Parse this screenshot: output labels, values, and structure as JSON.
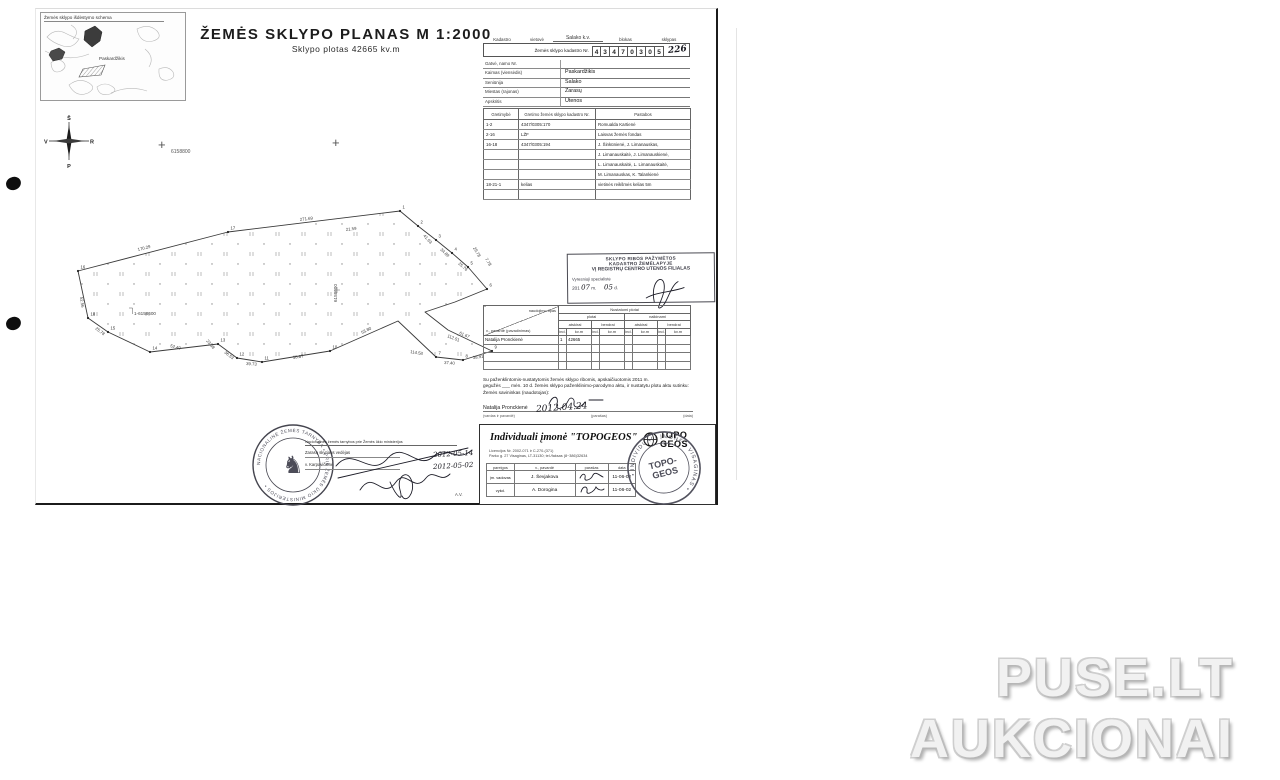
{
  "titles": {
    "main": "ŽEMĖS  SKLYPO  PLANAS  M 1:2000",
    "subtitle": "Sklypo  plotas 42665 kv.m"
  },
  "inset_map": {
    "title": "Žemės sklypo išdėstymo schema",
    "label1": "Paskardžikis"
  },
  "compass": {
    "north": "Š",
    "south": "P",
    "west": "V",
    "east": "R"
  },
  "grid": {
    "cross1_label": "6158800",
    "vertical_label": "6158600",
    "bracket_label": "1-6158600"
  },
  "cadastre_header": {
    "col_kadastro": "Kadastro",
    "col_vietove": "vietovė",
    "vietove_value": "Salako k.v.",
    "col_blokas": "blokas",
    "col_sklypas": "sklypas",
    "kadastro_nr_label": "Žemės sklypo kadastro Nr.",
    "digits": [
      "4",
      "3",
      "4",
      "7",
      "0",
      "3",
      "0",
      "5"
    ],
    "sklypas_handwritten": "226"
  },
  "location": {
    "rows": [
      {
        "label": "Gatvė, namo Nr.",
        "value": ""
      },
      {
        "label": "Kaimas (viensėdis)",
        "value": "Paskardžikis"
      },
      {
        "label": "Seniūnija",
        "value": "Salako"
      },
      {
        "label": "Miestas (rajonas)",
        "value": "Zarasų"
      },
      {
        "label": "Apskritis",
        "value": "Utenos"
      }
    ]
  },
  "adjacency": {
    "headers": [
      "Gretimybė",
      "Gretimo  žemės sklypo kadastro Nr.",
      "Pastabos"
    ],
    "rows": [
      [
        "1-2",
        "4347/0305:170",
        "Romualda Kartienė"
      ],
      [
        "2-16",
        "LŽF",
        "Laisvas žemės fondas"
      ],
      [
        "16-18",
        "4347/0305:194",
        "J. Šinkūnienė, J. Limanauskas,"
      ],
      [
        "",
        "",
        "J. Limanauskaitė, J. Limanauskienė,"
      ],
      [
        "",
        "",
        "L. Limanauskaitė, L. Limanauskaitė,"
      ],
      [
        "",
        "",
        "M. Limanauskas, K. Talankienė"
      ],
      [
        "18-21-1",
        "kelias",
        "vietinės reikšmės kelias 5m"
      ],
      [
        "",
        "",
        ""
      ]
    ]
  },
  "registry_stamp": {
    "line1": "SKLYPO RIBOS PAŽYMĖTOS",
    "line2": "KADASTRO ŽEMĖLAPYJE",
    "line3": "VĮ REGISTRŲ CENTRO UTENOS FILIALAS",
    "line4": "Vyresnioji specialistė",
    "date_prefix": "201",
    "m_label": "m.",
    "d_label": "d.",
    "hw_month": "07",
    "hw_day": "05"
  },
  "areas_table": {
    "diag_top": "naudojimo tipas",
    "diag_bottom": "v., pavardė (pavadinimas)",
    "group_title": "Nustatomi plotai",
    "group_left": "plotai",
    "group_right": "naikinami",
    "sub_left1": "atskirai",
    "sub_left2": "bendrai",
    "sub_right1": "atskirai",
    "sub_right2": "bendrai",
    "unit_ind": "ind.",
    "unit_kvm": "kv.m",
    "rows": [
      [
        "Natalija Pronckienė",
        "1",
        "42665",
        "",
        "",
        "",
        "",
        "",
        ""
      ],
      [
        "",
        "",
        "",
        "",
        "",
        "",
        "",
        "",
        ""
      ],
      [
        "",
        "",
        "",
        "",
        "",
        "",
        "",
        "",
        ""
      ],
      [
        "",
        "",
        "",
        "",
        "",
        "",
        "",
        "",
        ""
      ]
    ]
  },
  "agreement": {
    "line1": "Su paženklintomis-nustatytomis žemės sklypo ribomis, apskaičiuotomis 2011 m.",
    "line2": "gegužės ___ mėn. 10 d. žemės sklypo paženklinimo-parodymo aktu, ir nustatytu plotu aktu sutinku:",
    "line3": "Žemės savininkas (naudotojas):",
    "owner_name": "Natalija Pronckienė",
    "owner_date": "2012.04.24",
    "cap_name": "(vardas ir pavardė)",
    "cap_sig": "(parašas)",
    "cap_date": "(data)"
  },
  "surveyor": {
    "title": "Individuali įmonė \"TOPOGEOS\"",
    "logo_top": "TOPO",
    "logo_bottom": "GEOS",
    "license_line": "Licencijos Nr. 2002-071 ir C-270-(371)",
    "address_line": "Parko g. 27 Visaginas, LT-31130; tel./faksas (8~386)32634",
    "table_headers": [
      "pareigos",
      "v., pavardė",
      "parašas",
      "data"
    ],
    "rows": [
      {
        "role": "įm. vadovas",
        "name": "J. Ševjakova",
        "date": "11-06-02"
      },
      {
        "role": "vykd.",
        "name": "A. Dorogina",
        "date": "11-06-02"
      }
    ],
    "stamp_ring": "• INDIVIDUALI ĮMONĖ • VISAGINAS •",
    "stamp_center1": "TOPO-",
    "stamp_center2": "GEOS"
  },
  "approval": {
    "line1": "Nacionalinės žemės tarnybos prie Žemės ūkio ministerijos",
    "line2": "Zarasų skyriaus vedėjas",
    "line3": "v. Karpavičienė",
    "date1": "2012-05-14",
    "date2": "2012-05-02",
    "av": "A.V.",
    "seal_ring": "NACIONALINĖ ŽEMĖS TARNYBA • PRIE ŽEMĖS ŪKIO MINISTERIJOS •"
  },
  "watermark": {
    "line1": "PUSE.LT",
    "line2": "AUKCIONAI",
    "color": "#d9d9d9"
  },
  "drawing": {
    "polygon_points": "78,271 228,232 400,211 418,226 436,240 452,253 468,267 487,289 455,302 425,312 448,330 492,351 463,360 436,357 398,321 330,351 262,362 237,358 218,344 150,352 108,332 88,318",
    "edge_labels": [
      {
        "t": "170.29",
        "x": 138,
        "y": 251,
        "r": -14
      },
      {
        "t": "271.69",
        "x": 300,
        "y": 221,
        "r": -7
      },
      {
        "t": "21.59",
        "x": 346,
        "y": 231,
        "r": -7
      },
      {
        "t": "41.63",
        "x": 423,
        "y": 236,
        "r": 48
      },
      {
        "t": "34.89",
        "x": 440,
        "y": 250,
        "r": 44
      },
      {
        "t": "25.76",
        "x": 458,
        "y": 264,
        "r": 42
      },
      {
        "t": "29.78",
        "x": 473,
        "y": 248,
        "r": 60
      },
      {
        "t": "7.78",
        "x": 485,
        "y": 259,
        "r": 60
      },
      {
        "t": "112.51",
        "x": 447,
        "y": 337,
        "r": 22
      },
      {
        "t": "114.58",
        "x": 410,
        "y": 353,
        "r": 9
      },
      {
        "t": "61.67",
        "x": 459,
        "y": 334,
        "r": 24
      },
      {
        "t": "37.40",
        "x": 444,
        "y": 364,
        "r": 3
      },
      {
        "t": "38.91",
        "x": 473,
        "y": 359,
        "r": -7
      },
      {
        "t": "53.80",
        "x": 362,
        "y": 334,
        "r": -26
      },
      {
        "t": "58.67",
        "x": 293,
        "y": 359,
        "r": -9
      },
      {
        "t": "39.73",
        "x": 246,
        "y": 365,
        "r": 3
      },
      {
        "t": "36.53",
        "x": 224,
        "y": 353,
        "r": 38
      },
      {
        "t": "23.68",
        "x": 206,
        "y": 341,
        "r": 50
      },
      {
        "t": "52.40",
        "x": 170,
        "y": 347,
        "r": 14
      },
      {
        "t": "25.78",
        "x": 95,
        "y": 329,
        "r": 38
      },
      {
        "t": "52.56",
        "x": 80,
        "y": 297,
        "r": 83
      }
    ],
    "vertices": [
      {
        "n": "16",
        "x": 78,
        "y": 271
      },
      {
        "n": "17",
        "x": 228,
        "y": 232
      },
      {
        "n": "1",
        "x": 400,
        "y": 211
      },
      {
        "n": "2",
        "x": 418,
        "y": 226
      },
      {
        "n": "3",
        "x": 436,
        "y": 240
      },
      {
        "n": "4",
        "x": 452,
        "y": 253
      },
      {
        "n": "5",
        "x": 468,
        "y": 267
      },
      {
        "n": "6",
        "x": 487,
        "y": 289
      },
      {
        "n": "9",
        "x": 492,
        "y": 351
      },
      {
        "n": "8",
        "x": 463,
        "y": 360
      },
      {
        "n": "7",
        "x": 436,
        "y": 357
      },
      {
        "n": "10",
        "x": 330,
        "y": 351
      },
      {
        "n": "11",
        "x": 262,
        "y": 362
      },
      {
        "n": "12",
        "x": 237,
        "y": 358
      },
      {
        "n": "13",
        "x": 218,
        "y": 344
      },
      {
        "n": "14",
        "x": 150,
        "y": 352
      },
      {
        "n": "15",
        "x": 108,
        "y": 332
      },
      {
        "n": "18",
        "x": 88,
        "y": 318
      }
    ]
  }
}
